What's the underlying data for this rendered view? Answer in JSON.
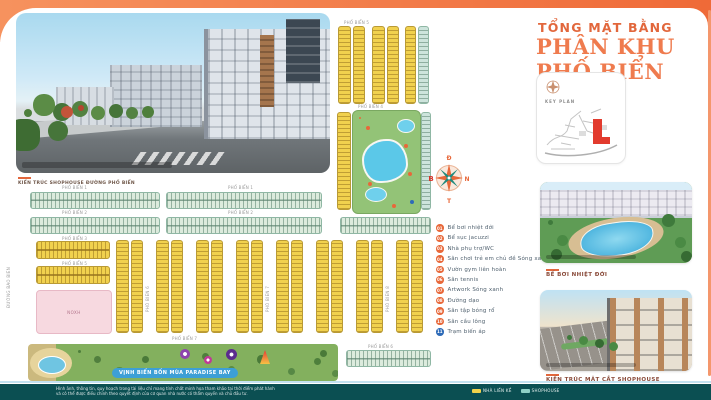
{
  "header": {
    "subtitle": "TỔNG MẶT BẰNG",
    "title": "PHÂN KHU PHỐ BIỂN"
  },
  "keyplan": {
    "label": "KEY PLAN"
  },
  "compass": {
    "top": "Đ",
    "left": "B",
    "right": "N",
    "bottom": "T"
  },
  "hero": {
    "caption": "KIẾN TRÚC SHOPHOUSE ĐƯỜNG PHỐ BIỂN"
  },
  "legend": {
    "items": [
      {
        "num": "01",
        "label": "Bể bơi nhiệt đới"
      },
      {
        "num": "02",
        "label": "Bể sục jacuzzi"
      },
      {
        "num": "03",
        "label": "Nhà phụ trợ/WC"
      },
      {
        "num": "04",
        "label": "Sân chơi trẻ em chủ đề Sóng xanh"
      },
      {
        "num": "05",
        "label": "Vườn gym liên hoàn"
      },
      {
        "num": "06",
        "label": "Sân tennis"
      },
      {
        "num": "07",
        "label": "Artwork Sóng xanh"
      },
      {
        "num": "08",
        "label": "Đường dạo"
      },
      {
        "num": "09",
        "label": "Sân tập bóng rổ"
      },
      {
        "num": "10",
        "label": "Sân cầu lông"
      },
      {
        "num": "11",
        "label": "Trạm biến áp"
      }
    ]
  },
  "photos": [
    {
      "caption": "BỂ BƠI NHIỆT ĐỚI"
    },
    {
      "caption": "KIẾN TRÚC MẶT CẮT SHOPHOUSE"
    }
  ],
  "map": {
    "bay_label": "VỊNH BIỂN BỐN MÙA PARADISE BAY",
    "pink_label": "NOXH",
    "side_street": "ĐƯỜNG BAO BIỂN",
    "streets": [
      "PHỐ BIỂN 1",
      "PHỐ BIỂN 2",
      "PHỐ BIỂN 3",
      "PHỐ BIỂN 4",
      "PHỐ BIỂN 5",
      "PHỐ BIỂN 6",
      "PHỐ BIỂN 7",
      "PHỐ BIỂN 8"
    ]
  },
  "footer": {
    "disclaimer_line1": "Hình ảnh, thông tin, quy hoạch trong tài liệu chỉ mang tính chất minh họa tham khảo tại thời điểm phát hành",
    "disclaimer_line2": "và có thể được điều chỉnh theo quyết định của cơ quan nhà nước có thẩm quyền và chủ đầu tư.",
    "legend": [
      {
        "label": "NHÀ LIỀN KỀ",
        "color": "#F2D24B"
      },
      {
        "label": "SHOPHOUSE",
        "color": "#8FD0C6"
      }
    ]
  },
  "colors": {
    "accent": "#E8683A",
    "title_orange": "#EF7B4E",
    "teal_bar": "#0B4F52",
    "lot_yellow": "#F1D14E",
    "lot_green": "#DCEBDD",
    "pool_blue": "#5BC8E8",
    "pink_block": "#F7D9E0",
    "keyplan_red": "#E23B2E",
    "bay_pill_blue": "#3D9FD6"
  }
}
